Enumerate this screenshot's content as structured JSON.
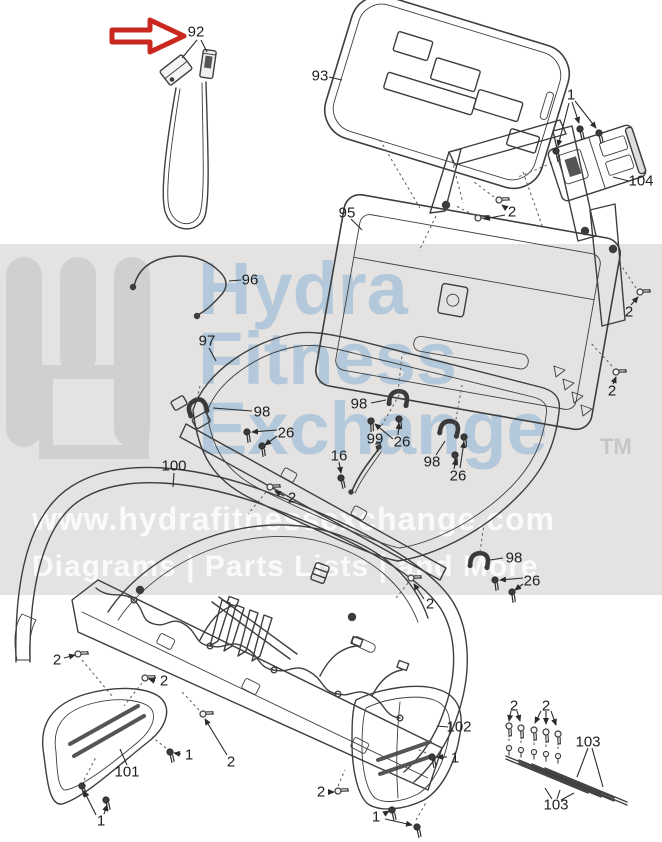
{
  "figure": {
    "type": "exploded-parts-diagram",
    "band_color": "#e4e3e1",
    "line_color": "#3e3e3e",
    "highlight_arrow_color": "#c8281e"
  },
  "watermark": {
    "brand_line1": "Hydra",
    "brand_line2": "Fitness",
    "brand_line3": "Exchange",
    "trademark": "TM",
    "url": "www.hydrafitnessexchange.com",
    "tagline": "Diagrams | Parts Lists | and More",
    "logo_color": "#c9ccce",
    "blue_text_color": "#a8c2da",
    "tm_color": "#c6c6c6"
  },
  "callouts": [
    {
      "text": "92",
      "x": 196,
      "y": 32
    },
    {
      "text": "93",
      "x": 320,
      "y": 76
    },
    {
      "text": "1",
      "x": 571,
      "y": 95
    },
    {
      "text": "104",
      "x": 641,
      "y": 181
    },
    {
      "text": "2",
      "x": 512,
      "y": 212
    },
    {
      "text": "95",
      "x": 347,
      "y": 213
    },
    {
      "text": "96",
      "x": 250,
      "y": 280
    },
    {
      "text": "97",
      "x": 207,
      "y": 341
    },
    {
      "text": "2",
      "x": 629,
      "y": 312
    },
    {
      "text": "2",
      "x": 612,
      "y": 391
    },
    {
      "text": "98",
      "x": 262,
      "y": 412
    },
    {
      "text": "26",
      "x": 286,
      "y": 433
    },
    {
      "text": "98",
      "x": 359,
      "y": 404
    },
    {
      "text": "26",
      "x": 402,
      "y": 442
    },
    {
      "text": "99",
      "x": 375,
      "y": 439
    },
    {
      "text": "16",
      "x": 339,
      "y": 456
    },
    {
      "text": "98",
      "x": 432,
      "y": 462
    },
    {
      "text": "26",
      "x": 458,
      "y": 476
    },
    {
      "text": "100",
      "x": 174,
      "y": 466
    },
    {
      "text": "2",
      "x": 292,
      "y": 498
    },
    {
      "text": "2",
      "x": 430,
      "y": 604
    },
    {
      "text": "98",
      "x": 514,
      "y": 558
    },
    {
      "text": "26",
      "x": 532,
      "y": 581
    },
    {
      "text": "2",
      "x": 57,
      "y": 660
    },
    {
      "text": "2",
      "x": 164,
      "y": 681
    },
    {
      "text": "1",
      "x": 189,
      "y": 755
    },
    {
      "text": "101",
      "x": 127,
      "y": 772
    },
    {
      "text": "1",
      "x": 101,
      "y": 821
    },
    {
      "text": "2",
      "x": 231,
      "y": 762
    },
    {
      "text": "2",
      "x": 321,
      "y": 792
    },
    {
      "text": "102",
      "x": 459,
      "y": 727
    },
    {
      "text": "1",
      "x": 455,
      "y": 758
    },
    {
      "text": "1",
      "x": 376,
      "y": 817
    },
    {
      "text": "2",
      "x": 514,
      "y": 706
    },
    {
      "text": "2",
      "x": 546,
      "y": 706
    },
    {
      "text": "103",
      "x": 588,
      "y": 742
    },
    {
      "text": "103",
      "x": 556,
      "y": 805
    }
  ]
}
